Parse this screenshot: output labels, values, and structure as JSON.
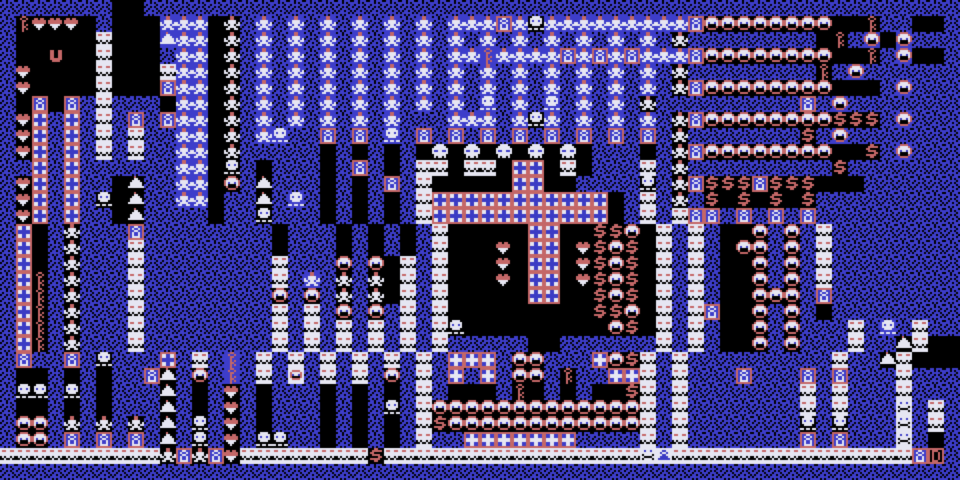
{
  "meta": {
    "description": "Retro tile-maze game board, 60x30 tiles of 16px, CGA-style blue/red/white palette",
    "player_glyph": "U",
    "grid": {
      "cols": 60,
      "rows": 30,
      "tile": 16,
      "pixel": 2
    }
  },
  "palette": {
    "r": "#c46767",
    "w": "#e6e6f2",
    "b": "#3b3bc4",
    "k": "#000000"
  },
  "backgrounds": {
    "blue": "#3d3dca",
    "black": "#000000",
    "white": "#e6e6f2"
  },
  "tiles": {
    "#": {
      "name": "speckled-wall",
      "bg": "blue",
      "sprite": [
        "k..k...k",
        "...k.k..",
        ".k....k.",
        "k..k.k..",
        "..k...k.",
        ".k..k..k",
        "k.....k.",
        "..k.k..."
      ]
    },
    ".": {
      "name": "empty-floor",
      "bg": "black",
      "sprite": []
    },
    "+": {
      "name": "cross-wall-white",
      "bg": "white",
      "sprite": [
        "rrrrrrrr",
        "r..bb..r",
        "r..bb..r",
        "rbbbbbbr",
        "rbbbbbbr",
        "r..bb..r",
        "r..bb..r",
        "rrrrrrrr"
      ]
    },
    "c": {
      "name": "cross-wall-blue",
      "bg": "blue",
      "sprite": [
        "rrrrrrrr",
        "r..ww..r",
        "r..ww..r",
        "rwwwwwwr",
        "rwwwwwwr",
        "r..ww..r",
        "r..ww..r",
        "rrrrrrrr"
      ]
    },
    "P": {
      "name": "pawn-statue-framed",
      "bg": "blue",
      "sprite": [
        "rrrrrrrr",
        "r..ww..r",
        "r.w..w.r",
        "r..ww..r",
        "r.w..w.r",
        "r.w..w.r",
        "r.wwww.r",
        "rrrrrrrr"
      ]
    },
    "D": {
      "name": "door-open",
      "bg": "black",
      "sprite": [
        "rrrrrrrr",
        "r.rrr..r",
        "r.r..r.r",
        "r.r..r.r",
        "r.r..r.r",
        "r.r..r.r",
        "r.rrr..r",
        "rrrrrrrr"
      ]
    },
    "m": {
      "name": "capped-monster",
      "bg": "blue",
      "sprite": [
        "...rr...",
        "...rr...",
        "..wwww..",
        "w.wwww.w",
        "ww.ww.ww",
        "..wwww..",
        ".ww..ww.",
        "........"
      ]
    },
    "M": {
      "name": "capped-monster-dark",
      "bg": "black",
      "sprite": [
        "...rr...",
        "...rr...",
        "..wwww..",
        "w.wwww.w",
        "ww.ww.ww",
        "..wwww..",
        ".ww..ww.",
        "........"
      ]
    },
    "S": {
      "name": "large-skull",
      "bg": "black",
      "sprite": [
        "..wwww..",
        ".wwwwww.",
        "wwwwwwww",
        "wbbwwbbw",
        "wwwwwwww",
        ".wwwwww.",
        ".w.ww.w.",
        "........"
      ]
    },
    "s": {
      "name": "skull-crossbones",
      "bg": "blue",
      "sprite": [
        "..wwww..",
        ".wwwwww.",
        ".wbwwbw.",
        ".wwwwww.",
        "..wwww..",
        "........",
        "ww.ww.ww",
        "........"
      ]
    },
    "z": {
      "name": "skull-crossbones-dark",
      "bg": "black",
      "sprite": [
        "..wwww..",
        ".wwwwww.",
        ".wbwwbw.",
        ".wwwwww.",
        "..wwww..",
        "........",
        "ww.ww.ww",
        "........"
      ]
    },
    "W": {
      "name": "face-brick-wall",
      "bg": "white",
      "sprite": [
        "........",
        ".rr..rr.",
        "........",
        "........",
        "k.k..k.k",
        "kk.kk.kk",
        "........",
        "........"
      ]
    },
    "Q": {
      "name": "face-in-brick",
      "bg": "white",
      "sprite": [
        "........",
        "..rrrr..",
        ".r....r.",
        ".rb..br.",
        ".rkkkkr.",
        "..rrrr..",
        "........",
        "........"
      ]
    },
    "h": {
      "name": "heart",
      "bg": "black",
      "sprite": [
        "........",
        ".rr.rr..",
        "rrrrrrr.",
        "rrrrrrr.",
        ".wwwww..",
        "..www...",
        "...w....",
        "........"
      ]
    },
    "k": {
      "name": "key",
      "bg": "black",
      "sprite": [
        "...rr...",
        "..r..r..",
        "...rr...",
        "...r....",
        "...r.r..",
        "...rr...",
        "...r.r..",
        "...r...."
      ]
    },
    "K": {
      "name": "key-on-blue",
      "bg": "blue",
      "sprite": [
        "...rr...",
        "..r..r..",
        "...rr...",
        "...r....",
        "...r.r..",
        "...rr...",
        "...r.r..",
        "...r...."
      ]
    },
    "$": {
      "name": "treasure-dollar",
      "bg": "black",
      "sprite": [
        "...rr...",
        "..rrrrr.",
        ".rr.....",
        "..rrrr..",
        ".....rr.",
        ".rrrrr..",
        "...rr...",
        "........"
      ]
    },
    "O": {
      "name": "pumpkin-face",
      "bg": "black",
      "sprite": [
        "..rrrr..",
        ".rwwwwr.",
        "rwwwwwwr",
        "rwbwwbwr",
        "rwkkkkwr",
        ".rkkkkr.",
        "..rrrr..",
        "........"
      ]
    },
    "o": {
      "name": "pumpkin-face-on-blue",
      "bg": "blue",
      "sprite": [
        "..rrrr..",
        ".rwwwwr.",
        "rwwwwwwr",
        "rwbwwbwr",
        "rwkkkkwr",
        ".rkkkkr.",
        "..rrrr..",
        "........"
      ]
    },
    "b": {
      "name": "slime-blob",
      "bg": "black",
      "sprite": [
        "...r....",
        "...ww...",
        "..wwww..",
        ".wwwwww.",
        ".wwwwww.",
        "wwwwwwww",
        "........",
        "........"
      ]
    },
    "B": {
      "name": "slime-blob-on-blue",
      "bg": "blue",
      "sprite": [
        "...r....",
        "...ww...",
        "..wwww..",
        ".wwwwww.",
        ".wwwwww.",
        "wwwwwwww",
        "........",
        "........"
      ]
    },
    "U": {
      "name": "player-u",
      "bg": "black",
      "sprite": [
        "........",
        ".rr..rr.",
        ".rr..rr.",
        ".rr..rr.",
        ".rr..rr.",
        ".rrrrrr.",
        "..rrrr..",
        "........"
      ]
    },
    "g": {
      "name": "skull-on-white",
      "bg": "white",
      "sprite": [
        "........",
        "..b..b..",
        "........",
        ".k....k.",
        "..kkkk..",
        ".k....k.",
        "........",
        "........"
      ]
    },
    "d": {
      "name": "pawn-on-white",
      "bg": "white",
      "sprite": [
        "........",
        "...bb...",
        "..b..b..",
        "...bb...",
        "..bbbb..",
        ".bbbbbb.",
        "........",
        "........"
      ]
    }
  },
  "map": [
    "#######..###################################################",
    "#khhh.#...mmm.M#m#m#m#m#m#m#mmmPmzmmmmmmmmmPOOOOOOOO..k##..#",
    "#.....W...Bmm.M#m#m#m#m#m#m#m#m#m#m#m#m#m#M########.k#o.o#",
    "#..U..W...#mm.M#m#m#m#m#m#m#mmKmmmmPmPmPmmmPOOOOOOOO..k#o..#",
    "#h....W...Wmm.M#m#m#m#m#m#m#m#m#m#m#m#m#m#M########k#o###",
    "#h....W...Pmm.M#m#m#m#m#m#m#m#m#m#m#m#m#m#MPOOOOOOOO...#o###",
    "#.P.P#W###.mm.M#m#m#m#m#m#m#m#s#m#s#m#m#M#########P#o###",
    "#h+#+#W#P#Pmm.M#m#m#m#m#m###mmm#mzm#m#m#m#MPOOOOOOOO$$$#o###",
    "#h+#+#W#W##mm.M#ms##P#P#s#P#P#P#P#P#P#P#P#M#######$#o###",
    "#h+#+#W#W##mm.M#####.#.#.#.S.S.S.S.S.###.#MPOOOOOOOO..$#o###",
    "##+#+######mm.z#.###.#P#.#WW.WW.++.W.###W#M#########$#####",
    "#h+#+##.b##mm.O#b###.#.#P#W.....++..####z#MP$$$P$$$...######",
    "#h+#+#z.b##mm.##b#s#.#.#.#W+++++++++++.#W#M#$.$.$.$#########",
    "#h+#+##.b####.##z###.#.#.#W+++++++++++.#W#WPP#P#P#P#########",
    "#+.#M###P########.###.#.#.#W.....++..$$O.W#W#..O#O#W#########",
    "#+.#M###W########.###.#.#.#W...h.++.h$O$.W#W#.OO#O#W#########",
    "#+.#M###W########W###O#O.W#W...h.++.h$O$.W#W#..O#O#W#########",
    "#+k#M###W########W#m#M#M.W#W...h.++.h$O$.W#W#..O#O#W#########",
    "#+k#M###W########O#O#M#M.W#W.....++..$O$.W#W#..OOO#P#########",
    "#+k#M###W########W#W#O#O#W#W.........$$O.W#WP..O#O#.#########",
    "#+k#M###W########W#W#W#W#W#Wz.........O$.W#W#..O#O###W#s#W###",
    "#+k#M###W########W#W#W#W#W#W#####..######W#W#..O#O###W##bW...",
    "#P##P#z###+#W#K#W#W#W#W#W#W#ccc#OO###cO$W#W#########W##bW...",
    "#..#.#.##Pb#O#K#W#Q#W#W#O#W#c#c#OO#k##ccW#W###P###P#P###W###",
    "#zz#z#.###b#.#h#.###.#.#.#W#...#k.#.#..$W#W#######W#W###W###",
    "#..#.#.###b#.#h#.###.#.#z#WOOOOOOOOOOOOOW#W#######W#W###g#W#",
    "#OO#M#M#M#b#z#h#.###.#.#.#W$OOOOOOOOOOOOW#W#######z#z###g#W#",
    "#OO#P#P#P#b#z#h#zz##.#.#.#W##ccccccc####W#W#######P#P###g#.#",
    "WWWWWWWWWWMPMPhWWWWWWWW$WWWWWWWWWWWWWWWWgdWWWWWWWWWWWWWWWPD#",
    "############################################################"
  ]
}
